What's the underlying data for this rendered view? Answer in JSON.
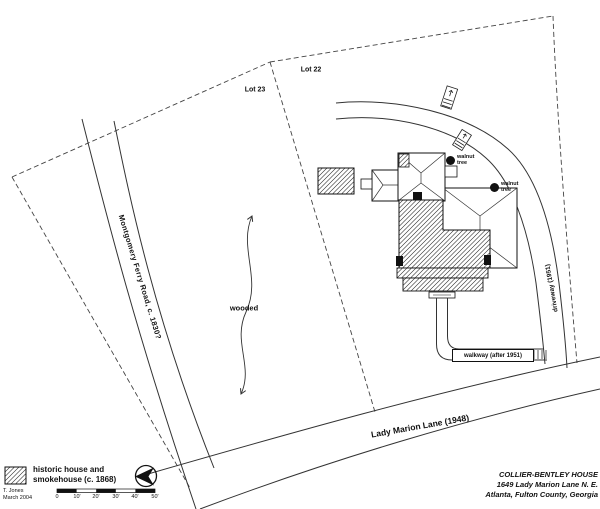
{
  "labels": {
    "lot23": "Lot 23",
    "lot22": "Lot 22",
    "montgomery_road": "Montgomery Ferry Road, c. 1830?",
    "lady_marion_lane": "Lady Marion Lane (1948)",
    "driveway": "driveway (1951)",
    "walkway": "walkway (after 1951)",
    "wooded": "wooded",
    "walnut_tree_line1": "walnut",
    "walnut_tree_line2": "tree"
  },
  "legend": {
    "swatch_icon": "diagonal-hatch-swatch",
    "label_line1": "historic house and",
    "label_line2": "smokehouse (c. 1868)",
    "north_arrow_icon": "compass-north-arrow"
  },
  "scale_bar": {
    "ticks": [
      "0",
      "10'",
      "20'",
      "30'",
      "40'",
      "50'"
    ]
  },
  "credit": {
    "author": "T. Jones",
    "date": "March 2004"
  },
  "title_block": {
    "line1": "COLLIER-BENTLEY HOUSE",
    "line2": "1649 Lady Marion Lane  N. E.",
    "line3": "Atlanta, Fulton County, Georgia"
  },
  "colors": {
    "ink": "#111111",
    "paper": "#ffffff"
  }
}
